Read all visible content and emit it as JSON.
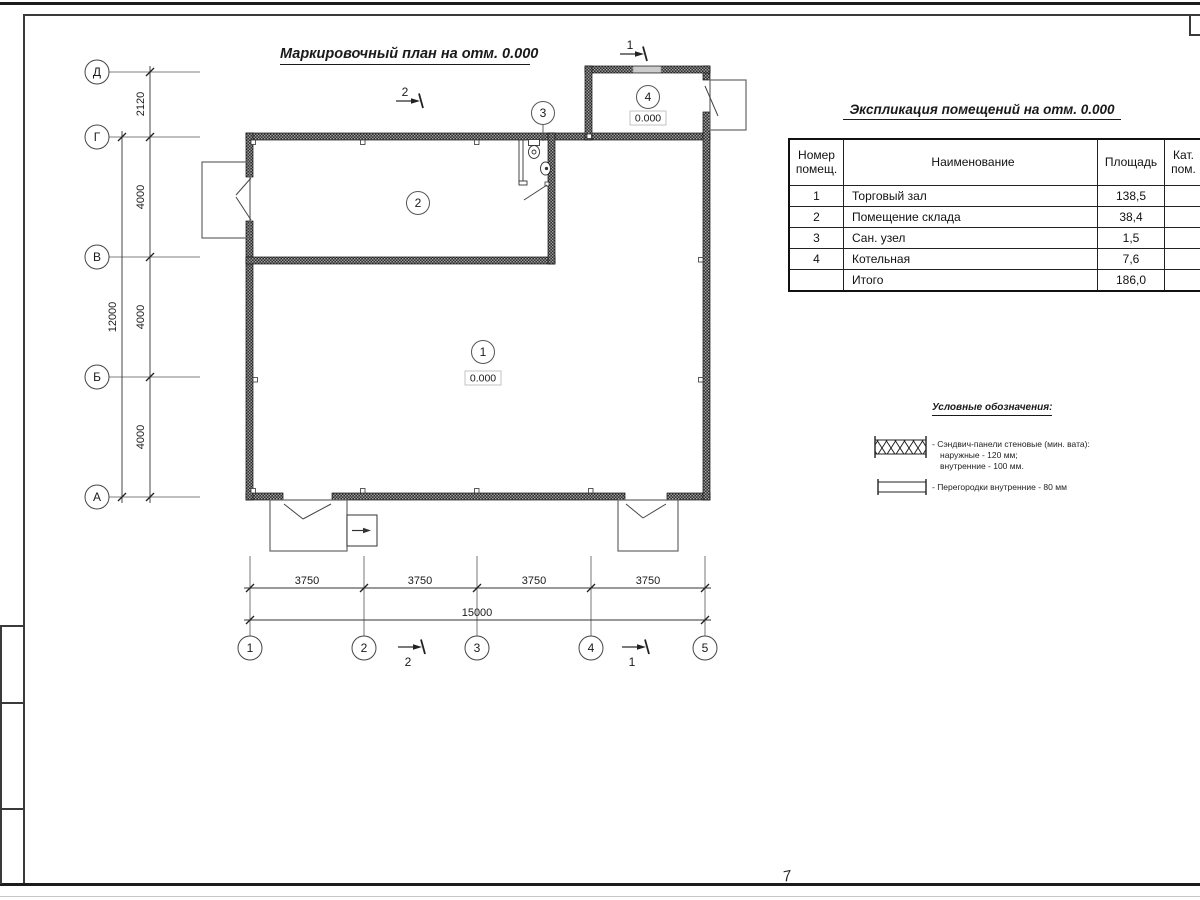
{
  "page": {
    "sheet_mark": "7"
  },
  "plan": {
    "title": "Маркировочный план на отм. 0.000",
    "axes": {
      "vertical": [
        "Д",
        "Г",
        "В",
        "Б",
        "А"
      ],
      "horizontal": [
        "1",
        "2",
        "3",
        "4",
        "5"
      ]
    },
    "dims": {
      "left": [
        "2120",
        "4000",
        "4000",
        "4000"
      ],
      "left_total": "12000",
      "bottom": [
        "3750",
        "3750",
        "3750",
        "3750"
      ],
      "bottom_total": "15000"
    },
    "rooms": [
      {
        "number": "1",
        "elevation": "0.000"
      },
      {
        "number": "2"
      },
      {
        "number": "3"
      },
      {
        "number": "4",
        "elevation": "0.000"
      }
    ],
    "sections": {
      "s1": "1",
      "s2": "2"
    }
  },
  "table": {
    "title": "Экспликация помещений на отм. 0.000",
    "headers": {
      "number": "Номер помещ.",
      "name": "Наименование",
      "area": "Площадь",
      "cat": "Кат. пом."
    },
    "rows": [
      {
        "number": "1",
        "name": "Торговый зал",
        "area": "138,5",
        "cat": ""
      },
      {
        "number": "2",
        "name": "Помещение склада",
        "area": "38,4",
        "cat": ""
      },
      {
        "number": "3",
        "name": "Сан. узел",
        "area": "1,5",
        "cat": ""
      },
      {
        "number": "4",
        "name": "Котельная",
        "area": "7,6",
        "cat": ""
      },
      {
        "number": "",
        "name": "Итого",
        "area": "186,0",
        "cat": ""
      }
    ]
  },
  "legend": {
    "title": "Условные обозначения:",
    "items": [
      {
        "symbol": "sandwich-panel-symbol",
        "lines": [
          "- Сэндвич-панели стеновые (мин. вата):",
          "наружные - 120 мм;",
          "внутренние - 100 мм."
        ]
      },
      {
        "symbol": "partition-symbol",
        "lines": [
          "- Перегородки внутренние - 80 мм"
        ]
      }
    ]
  },
  "colors": {
    "line": "#1a1a1a",
    "wall": "#2e2e2e"
  }
}
